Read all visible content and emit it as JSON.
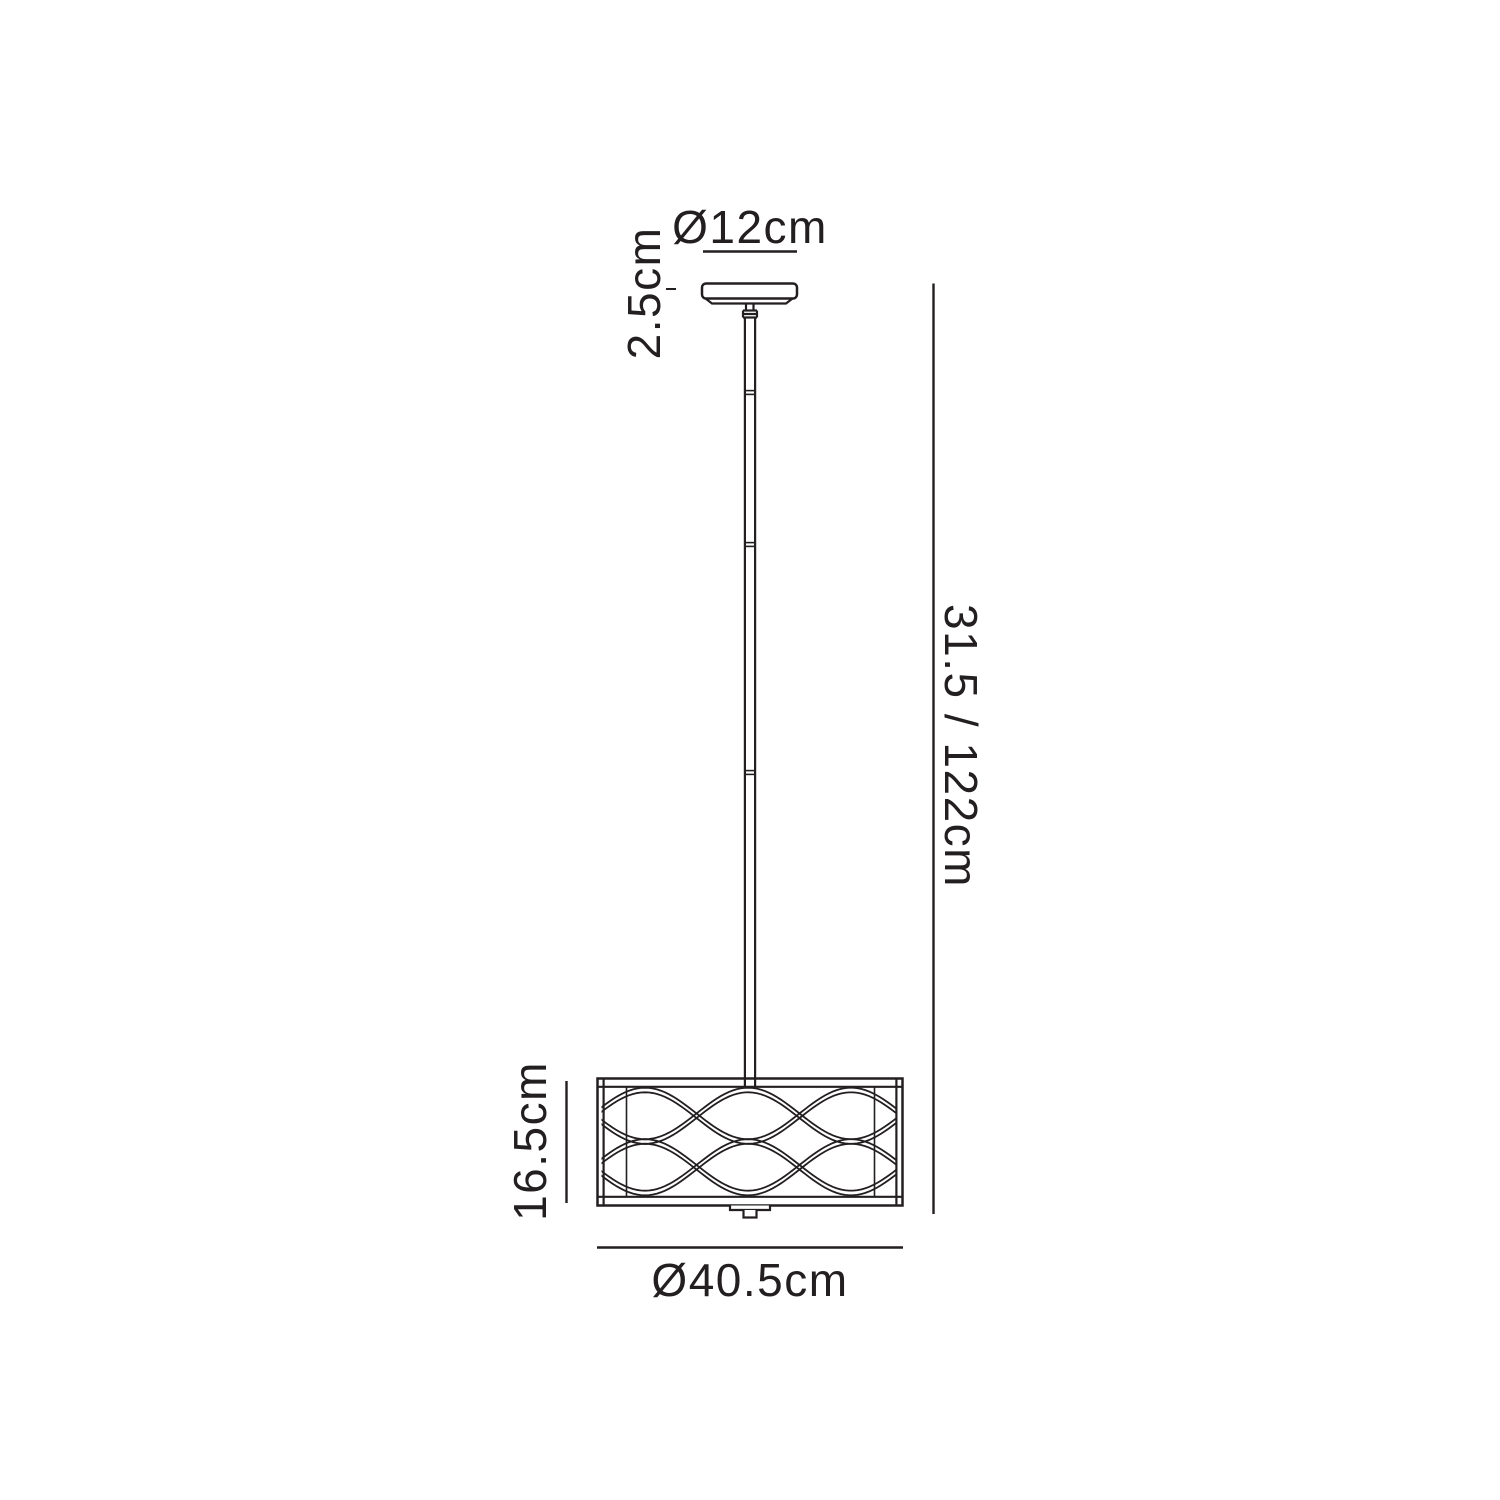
{
  "diagram": {
    "labels": {
      "canopy_diameter": "Ø12cm",
      "canopy_height": "2.5cm",
      "overall_drop": "31.5 / 122cm",
      "shade_height": "16.5cm",
      "shade_diameter": "Ø40.5cm"
    },
    "colors": {
      "line": "#231f20",
      "background": "#ffffff"
    }
  }
}
